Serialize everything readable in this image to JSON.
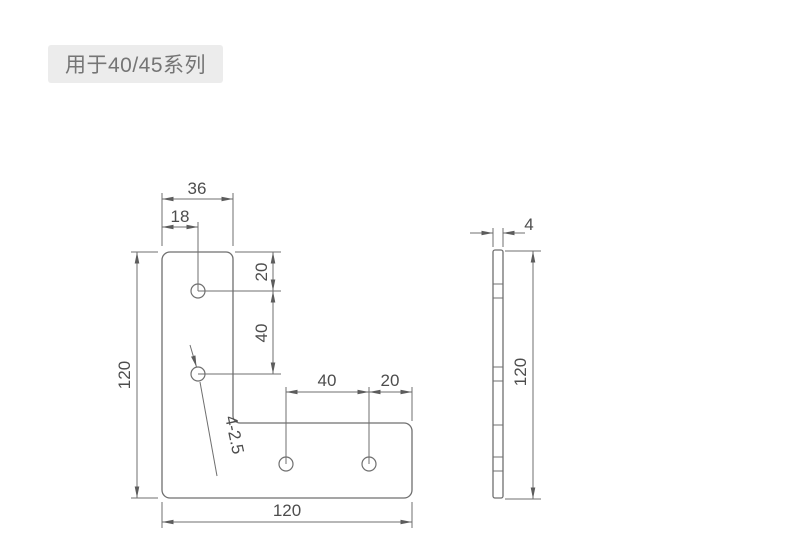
{
  "label": {
    "text": "用于40/45系列"
  },
  "colors": {
    "background": "#ffffff",
    "line": "#6f6f6f",
    "dimension_text": "#4d4d4d",
    "label_background": "#ececec",
    "label_text": "#757575"
  },
  "front_view": {
    "dim_top_width": "36",
    "dim_hole_offset_x": "18",
    "dim_hole_top_offset": "20",
    "dim_hole_pitch_left": "40",
    "dim_height": "120",
    "dim_hole_pitch_bottom": "40",
    "dim_hole_edge_offset": "20",
    "dim_width": "120",
    "hole_callout": "4-2.5"
  },
  "side_view": {
    "dim_thickness": "4",
    "dim_height": "120"
  }
}
